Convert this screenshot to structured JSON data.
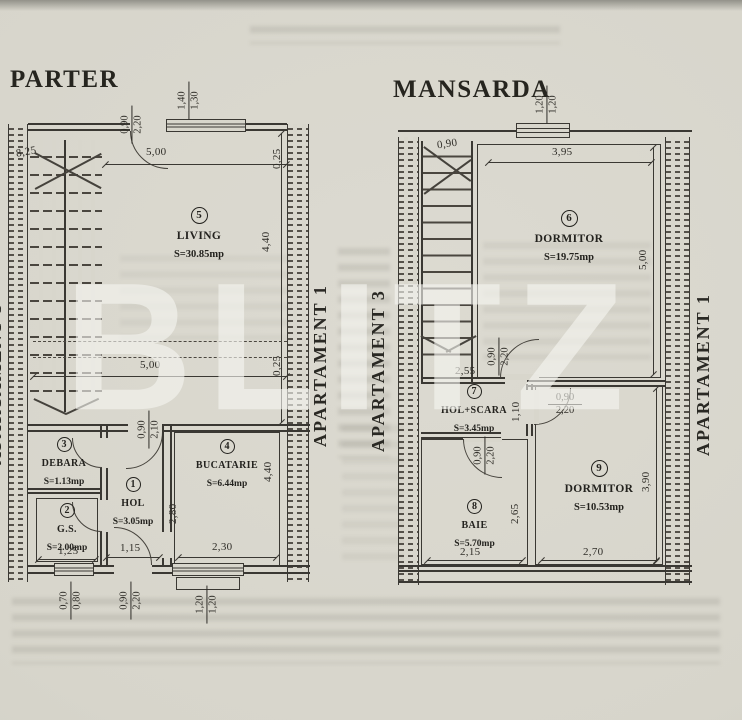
{
  "photo": {
    "watermark": "BLITZ"
  },
  "parter": {
    "title": "PARTER",
    "apt_right": "APARTAMENT 1",
    "apt_left_partial": "APARTAMENT 3",
    "rooms": {
      "living": {
        "num": "5",
        "name": "LIVING",
        "area": "S=30.85mp"
      },
      "debara": {
        "num": "3",
        "name": "DEBARA",
        "area": "S=1.13mp"
      },
      "gs": {
        "num": "2",
        "name": "G.S.",
        "area": "S=2.00mp"
      },
      "hol": {
        "num": "1",
        "name": "HOL",
        "area": "S=3.05mp"
      },
      "bucatarie": {
        "num": "4",
        "name": "BUCATARIE",
        "area": "S=6.44mp"
      }
    },
    "dims": {
      "top_door": {
        "w": "0,90",
        "h": "2,20"
      },
      "top_window": {
        "w": "1,40",
        "h": "1,30"
      },
      "total_diag": "8,25",
      "living_w_top": "5,00",
      "living_w_bot": "5,00",
      "wall_top": "0,25",
      "wall_mid": "0,25",
      "living_h": "4,40",
      "hol_door": {
        "w": "0,90",
        "h": "2,10"
      },
      "hol_h": "2,80",
      "hol_w": "1,15",
      "buc_w": "2,30",
      "buc_h": "4,40",
      "gs_w": "1,25",
      "gs_window": {
        "w": "0,70",
        "h": "0,80"
      },
      "entry_door": {
        "w": "0,90",
        "h": "2,20"
      },
      "buc_window": {
        "w": "1,20",
        "h": "1,20"
      }
    }
  },
  "mansarda": {
    "title": "MANSARDA",
    "apt_left": "APARTAMENT 3",
    "apt_right": "APARTAMENT 1",
    "rooms": {
      "dormitor6": {
        "num": "6",
        "name": "DORMITOR",
        "area": "S=19.75mp"
      },
      "hol_scara": {
        "num": "7",
        "name": "HOL+SCARA",
        "area": "S=3.45mp"
      },
      "baie": {
        "num": "8",
        "name": "BAIE",
        "area": "S=5.70mp"
      },
      "dormitor9": {
        "num": "9",
        "name": "DORMITOR",
        "area": "S=10.53mp"
      }
    },
    "dims": {
      "top_window": {
        "w": "1,20",
        "h": "1,20"
      },
      "stair_w": "0,90",
      "dorm6_w": "3,95",
      "dorm6_h": "5,00",
      "hol_w": "2,55",
      "hol_top_door": {
        "w": "0,90",
        "h": "2,20"
      },
      "hol_h": "1,10",
      "dorm9_door": {
        "w": "0,90",
        "h": "2,20"
      },
      "baie_door": {
        "w": "0,90",
        "h": "2,20"
      },
      "baie_h": "2,65",
      "baie_w": "2,15",
      "dorm9_h": "3,90",
      "dorm9_w": "2,70"
    }
  }
}
